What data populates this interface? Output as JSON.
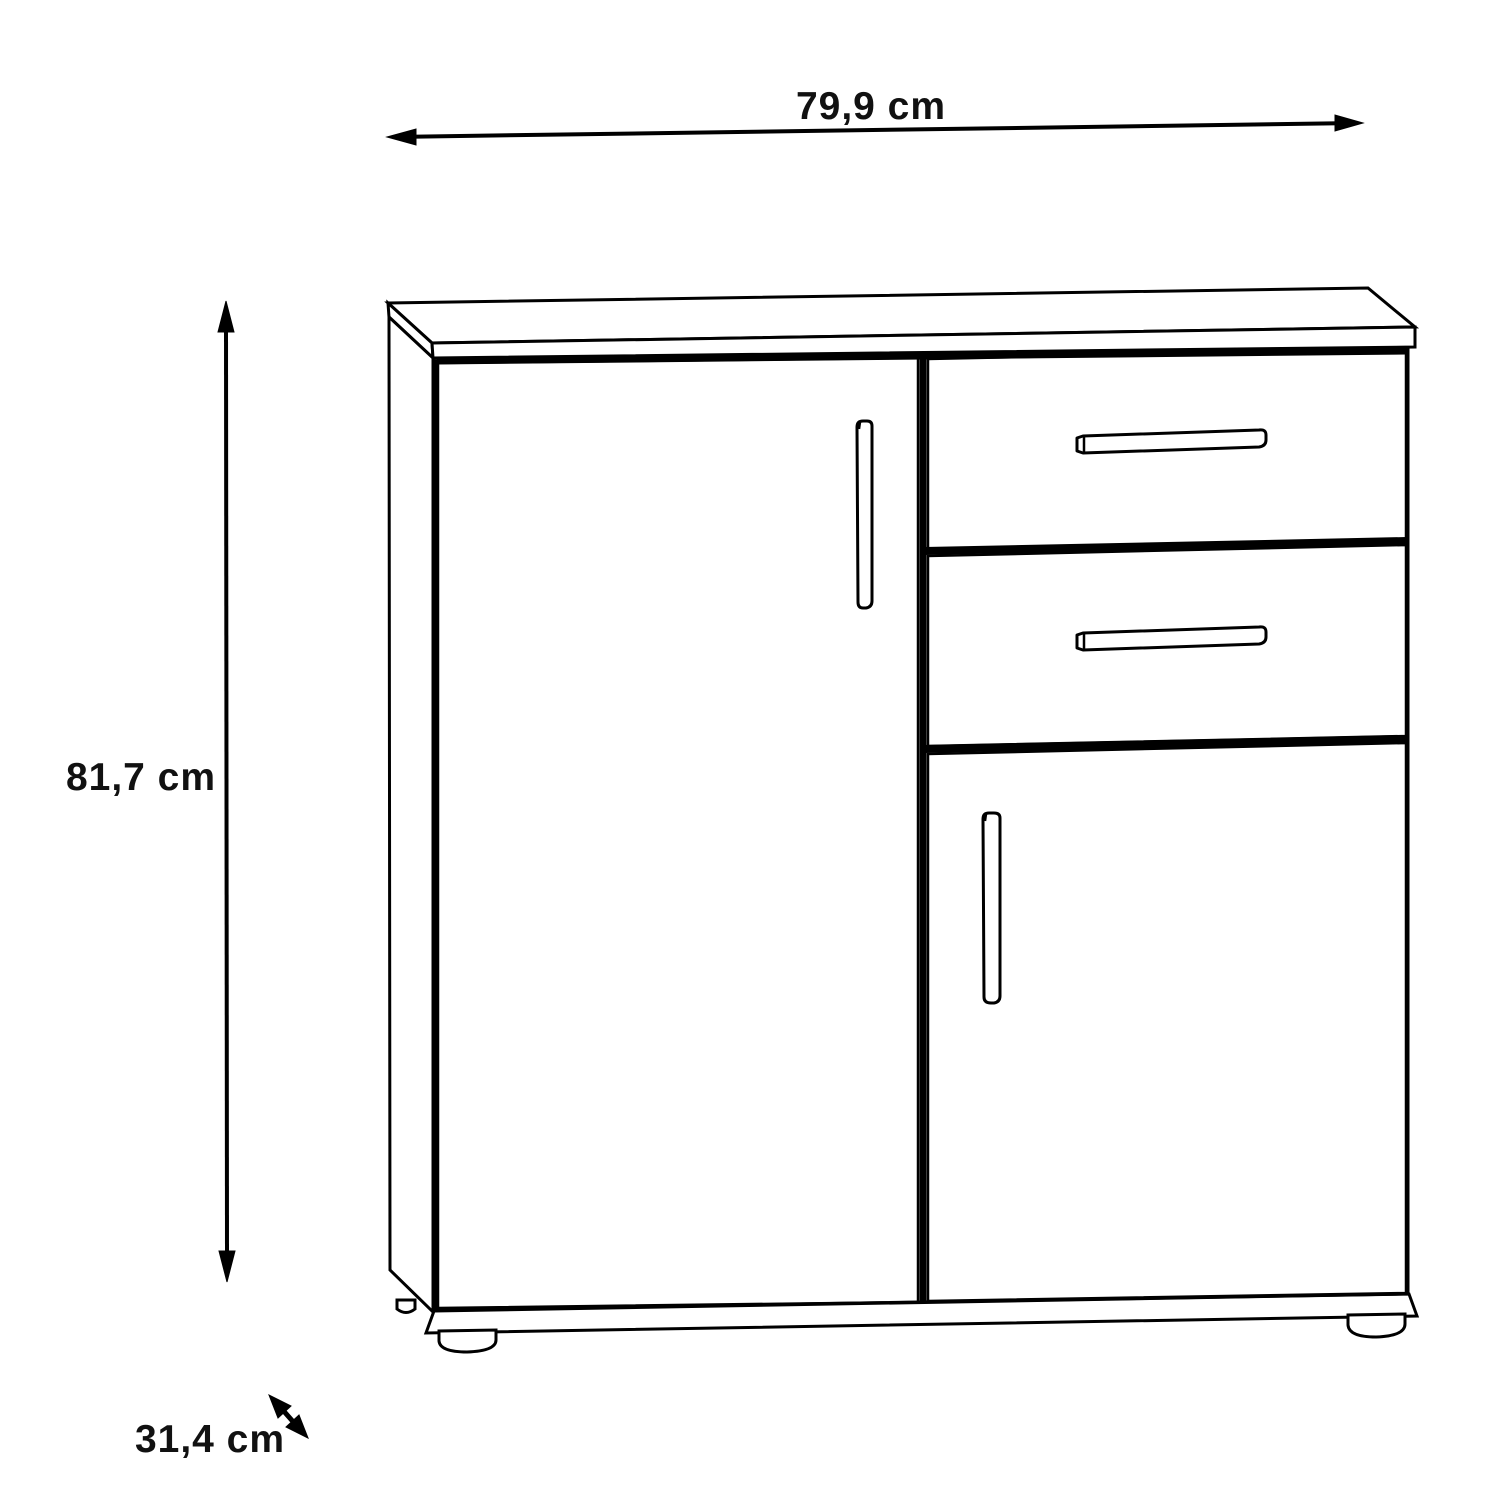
{
  "dimensions": {
    "width": {
      "label": "79,9 cm"
    },
    "height": {
      "label": "81,7 cm"
    },
    "depth": {
      "label": "31,4 cm"
    }
  },
  "colors": {
    "line": "#000000",
    "background": "#ffffff",
    "text": "#111111"
  }
}
